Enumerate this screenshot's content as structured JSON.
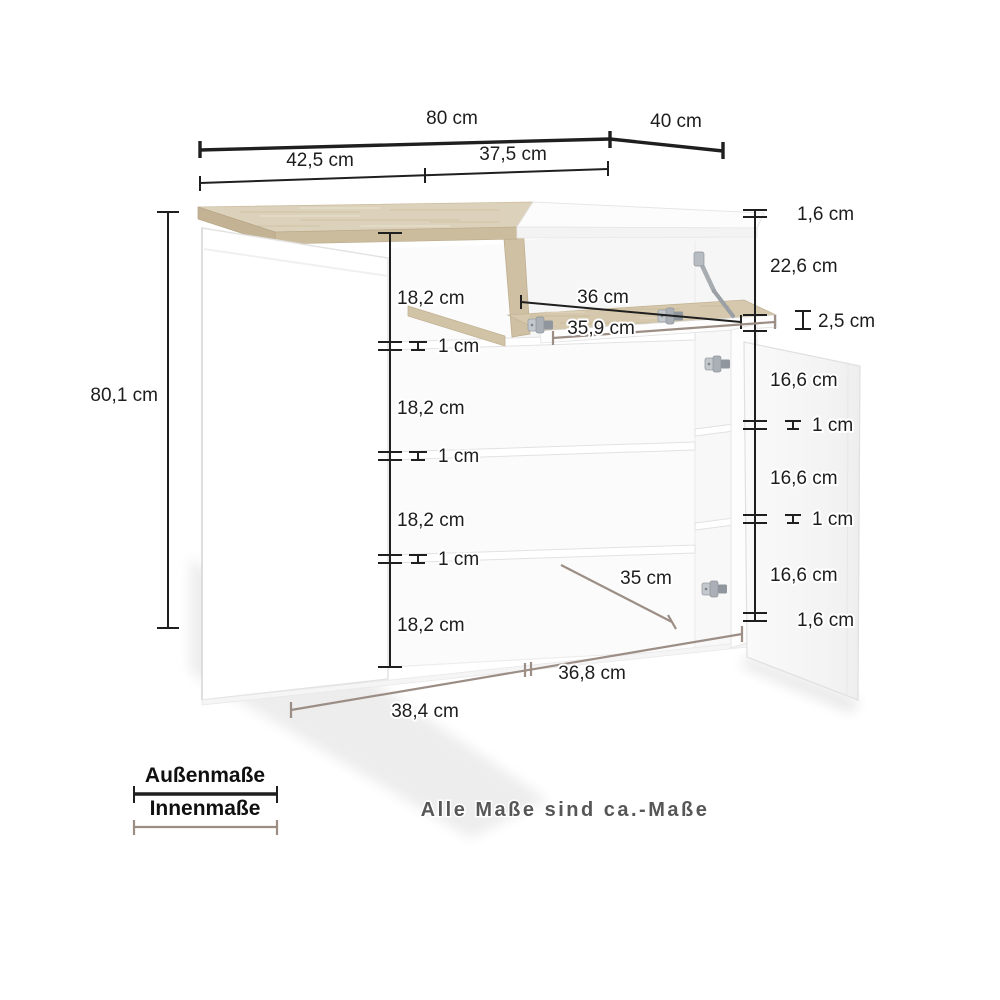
{
  "note": "Alle Maße sind ca.-Maße",
  "legend": {
    "outer": "Außenmaße",
    "inner": "Innenmaße"
  },
  "dims": {
    "width_total": "80 cm",
    "depth_total": "40 cm",
    "width_left_section": "42,5 cm",
    "width_right_section": "37,5 cm",
    "height_total": "80,1 cm",
    "left_gaps": [
      "18,2 cm",
      "18,2 cm",
      "18,2 cm",
      "18,2 cm"
    ],
    "left_shelf_thk": [
      "1 cm",
      "1 cm",
      "1 cm"
    ],
    "top_panel_thk": "1,6 cm",
    "flap_opening_h": "22,6 cm",
    "flap_thk": "2,5 cm",
    "right_gaps": [
      "16,6 cm",
      "16,6 cm",
      "16,6 cm"
    ],
    "right_shelf_thk": [
      "1 cm",
      "1 cm"
    ],
    "bottom_panel_thk": "1,6 cm",
    "flap_w_outer": "36 cm",
    "flap_w_inner": "35,9 cm",
    "depth_inner": "35 cm",
    "bottom_w_left": "38,4 cm",
    "bottom_w_right": "36,8 cm"
  },
  "colors": {
    "outer_line": "#1f1f1f",
    "inner_line": "#9c8e85",
    "note_text": "#575757",
    "wood": "#dcd2bc",
    "wood_edge": "#cbbc9e",
    "shadow": "#ededed"
  }
}
